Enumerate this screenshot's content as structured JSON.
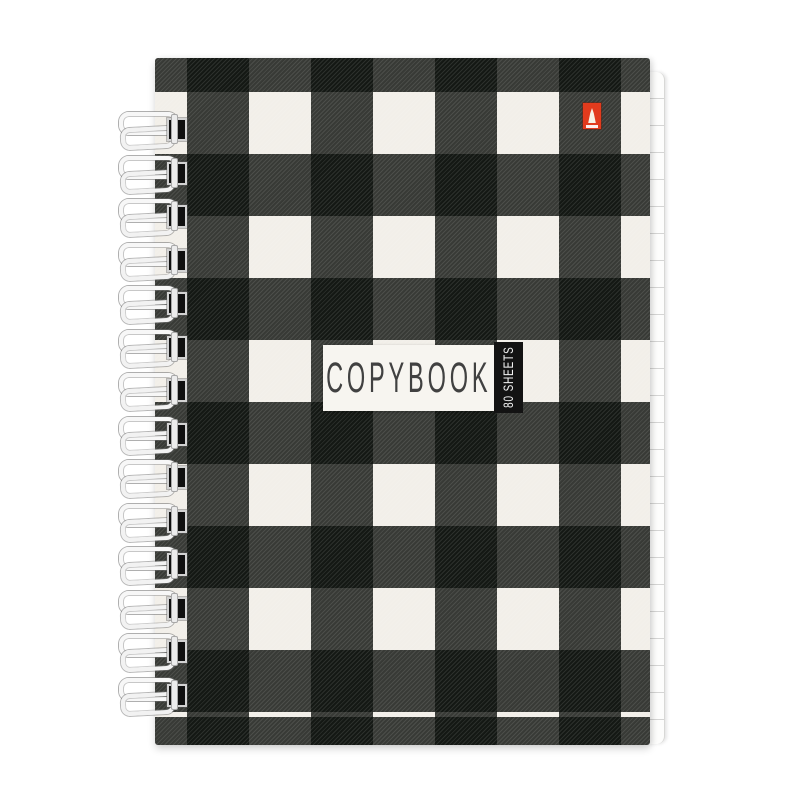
{
  "label": {
    "title": "COPYBOOK",
    "sheets": "80 SHEETS"
  },
  "colors": {
    "page_bg": "#ffffff",
    "cover_cream": "#f2efe9",
    "cover_black": "#1d211c",
    "cover_hatched": "#3a3e3a",
    "badge_red": "#e23b1d",
    "label_bg": "#f7f5f0",
    "label_text": "#414141",
    "strip_bg": "#131313",
    "strip_text": "#f2f2f2"
  },
  "spiral": {
    "ring_count": 14
  }
}
